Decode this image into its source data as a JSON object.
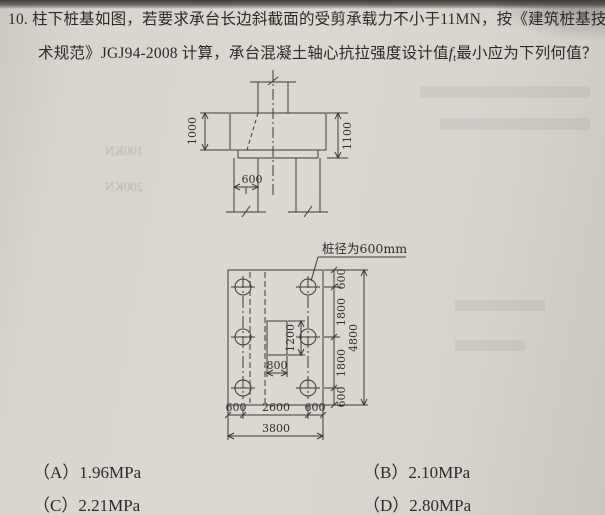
{
  "question": {
    "number": "10.",
    "line1": "柱下桩基如图，若要求承台长边斜截面的受剪承载力不小于11MN，按《建筑桩基技",
    "line2_pre": "术规范》JGJ94-2008 计算，承台混凝土轴心抗拉强度设计值",
    "symbol": "f",
    "symbol_sub": "t",
    "line2_post": "最小应为下列何值？"
  },
  "figure": {
    "elevation": {
      "dim_left": "1000",
      "dim_right": "1100",
      "dim_pile_width": "600"
    },
    "plan": {
      "pile_note": "桩径为600mm",
      "dim_col_height": "1200",
      "dim_col_width": "800",
      "right_chain": [
        "600",
        "1800",
        "1800",
        "600"
      ],
      "right_total": "4800",
      "bottom_chain": [
        "600",
        "2600",
        "600"
      ],
      "bottom_total": "3800"
    }
  },
  "options": [
    {
      "label": "（A）",
      "value": "1.96MPa"
    },
    {
      "label": "（B）",
      "value": "2.10MPa"
    },
    {
      "label": "（C）",
      "value": "2.21MPa"
    },
    {
      "label": "（D）",
      "value": "2.80MPa"
    }
  ],
  "bleed": {
    "t1": "100KN",
    "t2": "200KN"
  }
}
